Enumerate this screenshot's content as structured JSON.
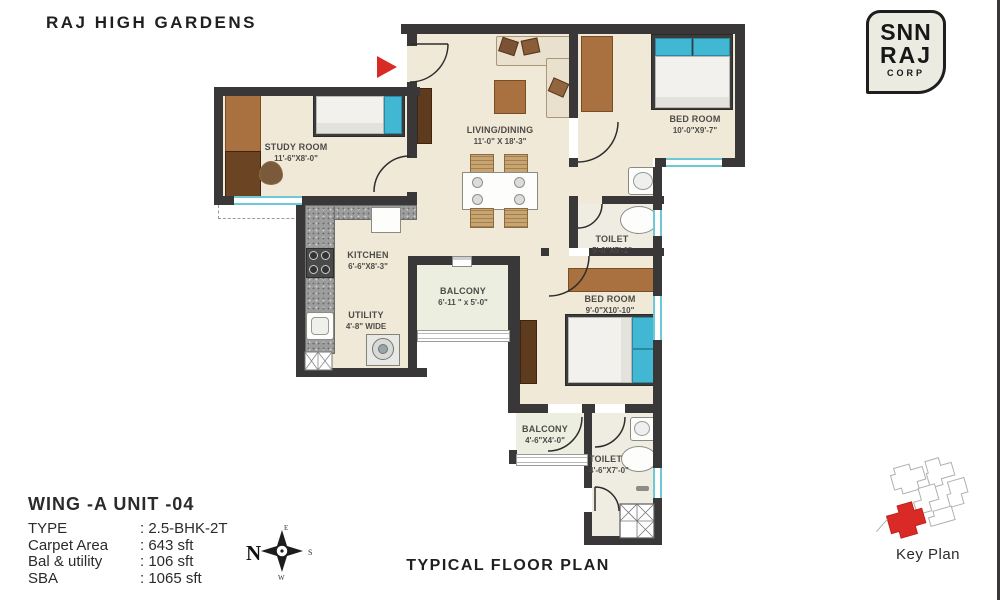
{
  "title": "RAJ HIGH GARDENS",
  "logo": {
    "line1": "SNN",
    "line2": "RAJ",
    "line3": "CORP"
  },
  "plan": {
    "rooms": [
      {
        "name": "STUDY ROOM",
        "dims": "11'-6\"X8'-0\""
      },
      {
        "name": "LIVING/DINING",
        "dims": "11'-0\" X 18'-3\""
      },
      {
        "name": "BED ROOM",
        "dims": "10'-0\"X9'-7\""
      },
      {
        "name": "TOILET",
        "dims": "5'-0\"X5'-1\""
      },
      {
        "name": "KITCHEN",
        "dims": "6'-6\"X8'-3\""
      },
      {
        "name": "UTILITY",
        "dims": "4'-8\" WIDE"
      },
      {
        "name": "BALCONY",
        "dims": "6'-11 \" x 5'-0\""
      },
      {
        "name": "BED ROOM",
        "dims": "9'-0\"X10'-10\""
      },
      {
        "name": "BALCONY",
        "dims": "4'-6\"X4'-0\""
      },
      {
        "name": "TOILET",
        "dims": "4'-6\"X7'-0\""
      }
    ]
  },
  "info": {
    "wing_unit": "WING -A  UNIT -04",
    "rows": [
      {
        "label": "TYPE",
        "value": ": 2.5-BHK-2T"
      },
      {
        "label": "Carpet Area",
        "value": ": 643 sft"
      },
      {
        "label": "Bal & utility",
        "value": ": 106 sft"
      },
      {
        "label": "SBA",
        "value": ": 1065 sft"
      }
    ]
  },
  "compass": {
    "n": "N",
    "e": "E",
    "s": "S",
    "w": "W"
  },
  "footer": {
    "caption": "TYPICAL FLOOR PLAN",
    "key_plan_label": "Key Plan"
  },
  "colors": {
    "wall": "#3a3738",
    "floor": "#f1e9d8",
    "window": "#6cc9d7",
    "wood": "#a9713f",
    "accent_red": "#d92a25",
    "pillow_blue": "#41b7d3"
  }
}
